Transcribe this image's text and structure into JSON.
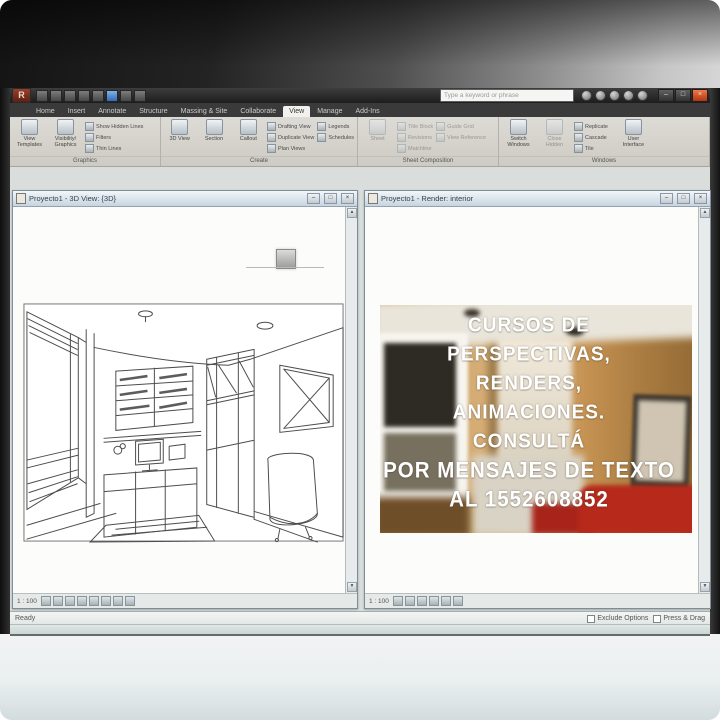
{
  "overlay": {
    "line1": "CURSOS DE",
    "line2": "PERSPECTIVAS,",
    "line3": "RENDERS,",
    "line4": "ANIMACIONES.",
    "line5": "CONSULTÁ",
    "line6": "POR MENSAJES DE TEXTO",
    "line7": "AL 1552608852",
    "text_color": "#ffffff"
  },
  "titlebar": {
    "app_initial": "R",
    "search_placeholder": "Type a keyword or phrase",
    "min": "–",
    "max": "□",
    "close": "×"
  },
  "tabs": {
    "t0": "Home",
    "t1": "Insert",
    "t2": "Annotate",
    "t3": "Structure",
    "t4": "Massing & Site",
    "t5": "Collaborate",
    "t6": "View",
    "t7": "Manage",
    "t8": "Add-Ins"
  },
  "ribbon": {
    "graphics": {
      "label": "Graphics",
      "b1": "View Templates",
      "b2": "Visibility/ Graphics",
      "s1": "Show Hidden Lines",
      "s2": "Filters",
      "s3": "Thin Lines"
    },
    "create": {
      "label": "Create",
      "b1": "3D View",
      "b2": "Section",
      "b3": "Callout",
      "s1": "Drafting View",
      "s2": "Duplicate View",
      "s3": "Legends",
      "s4": "Schedules",
      "s5": "Plan Views"
    },
    "sheet": {
      "label": "Sheet Composition",
      "b1": "Sheet",
      "s1": "Title Block",
      "s2": "Revisions",
      "s3": "Matchline",
      "s4": "Guide Grid",
      "s5": "View Reference"
    },
    "windows": {
      "label": "Windows",
      "b1": "Switch Windows",
      "b2": "Close Hidden",
      "b3": "User Interface",
      "s1": "Replicate",
      "s2": "Cascade",
      "s3": "Tile"
    }
  },
  "left_window": {
    "title": "Proyecto1 - 3D View: {3D}",
    "scale": "1 : 100",
    "min": "–",
    "max": "□",
    "close": "×"
  },
  "right_window": {
    "title": "Proyecto1 - Render: interior",
    "scale": "1 : 100",
    "min": "–",
    "max": "□",
    "close": "×"
  },
  "statusbar": {
    "ready": "Ready",
    "opt1": "Exclude Options",
    "opt2": "Press & Drag"
  },
  "colors": {
    "accent_red": "#b7291b",
    "wall_tan": "#c99a5e",
    "chrome_dark": "#262626",
    "overlay_white": "#ffffff"
  }
}
